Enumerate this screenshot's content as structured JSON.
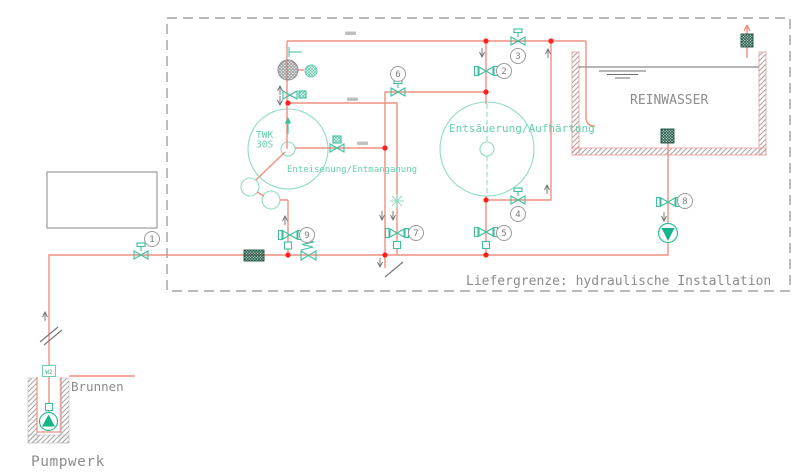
{
  "diagram": {
    "boundary": {
      "label": "Liefergrenze: hydraulische Installation"
    },
    "clean_water_tank": {
      "label": "REINWASSER"
    },
    "filter_tank": {
      "tag_line1": "TWK",
      "tag_line2": "30S",
      "process_label": "Enteisenung/Entmanganung"
    },
    "reactor_tank": {
      "process_label": "Entsäuerung/Aufhärtung"
    },
    "well": {
      "label": "Brunnen",
      "meter_label": "W2"
    },
    "station_label": "Pumpwerk",
    "valve_tags": [
      {
        "label": "1"
      },
      {
        "label": "2"
      },
      {
        "label": "3"
      },
      {
        "label": "4"
      },
      {
        "label": "5"
      },
      {
        "label": "6"
      },
      {
        "label": "7"
      },
      {
        "label": "8"
      },
      {
        "label": "9"
      }
    ],
    "colors": {
      "pipe": "#f29080",
      "junction_dot": "#ff1f1f",
      "symbol_green": "#3dbf9e",
      "tank_green": "#8fdcc4",
      "text_green": "#66cfae",
      "screen_dark": "#174f3e",
      "annotation_gray": "#8c8c8c",
      "wall_edge_red": "#ef9a9a"
    }
  }
}
